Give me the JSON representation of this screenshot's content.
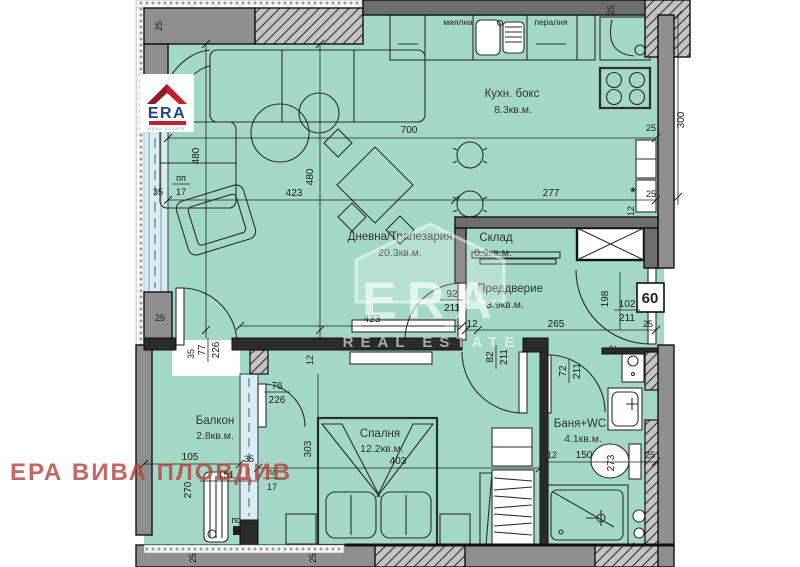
{
  "watermarks": {
    "era_text": "ERA",
    "era_subtext": "REAL ESTATE",
    "agency_stamp": "ЕРА ВИВА ПЛОВДИВ"
  },
  "logo": {
    "brand": "ERA",
    "brand_sub": "REAL ESTATE"
  },
  "rooms": {
    "kitchen": {
      "name": "Кухн. бокс",
      "area": "8.3кв.м."
    },
    "living": {
      "name": "Дневна/Трапезария",
      "area": "20.3кв.м."
    },
    "storage": {
      "name": "Склад",
      "area": "0.9кв.м."
    },
    "hall": {
      "name": "Преддверие",
      "area": "3.9кв.м."
    },
    "balcony": {
      "name": "Балкон",
      "area": "2.8кв.м."
    },
    "bedroom": {
      "name": "Спалня",
      "area": "12.2кв.м.",
      "width_dim": "403"
    },
    "bath": {
      "name": "Баня+WC",
      "area": "4.1кв.м."
    }
  },
  "appliances": {
    "dishwasher": "миялна",
    "washer": "пералня"
  },
  "dims": {
    "top_width": "700",
    "living_width": "423",
    "tv_wall": "423",
    "kitchen_width": "277",
    "living_height_left": "480",
    "living_height_mid": "480",
    "kitchen_height": "300",
    "wt_top_left": "25",
    "wt_top_right": "25",
    "wt_right_upper": "25",
    "wt_right_lower": "25",
    "wt_right_12": "12",
    "asterisk": "*",
    "hall_12": "12",
    "hall_265": "265",
    "hall_25": "25",
    "hall_198": "198",
    "panel_60": "60",
    "hall_right_12": "12",
    "left_25": "25",
    "left_35": "35",
    "tl_35": "35",
    "tl_pp": "пп",
    "tl_17": "17",
    "tv_12": "12",
    "balcony_105": "105",
    "balcony_270": "270",
    "balcony_151": "151",
    "balcony_35": "35",
    "pl": "пл",
    "pl_17": "17",
    "ps": "пс",
    "bedroom_303": "303",
    "bath_12": "12",
    "bath_150": "150",
    "bath_273": "273",
    "bath_25": "25",
    "bottom_25_a": "25",
    "bottom_25_b": "25"
  },
  "doors": {
    "living_hall": {
      "num": "92",
      "den": "211"
    },
    "entrance": {
      "num": "102",
      "den": "211"
    },
    "bedroom": {
      "num": "82",
      "den": "211"
    },
    "bath": {
      "num": "72",
      "den": "211"
    },
    "living_balcony": {
      "num": "77",
      "den": "226"
    },
    "balcony_bedroom": {
      "num": "76",
      "den": "226"
    }
  },
  "colors": {
    "floor": "#a2d8c5",
    "wall": "#8f8f8f",
    "window": "#d8edf3",
    "watermark_red": "#b5423c",
    "era_red": "#c21f2f",
    "era_blue": "#23418e"
  }
}
